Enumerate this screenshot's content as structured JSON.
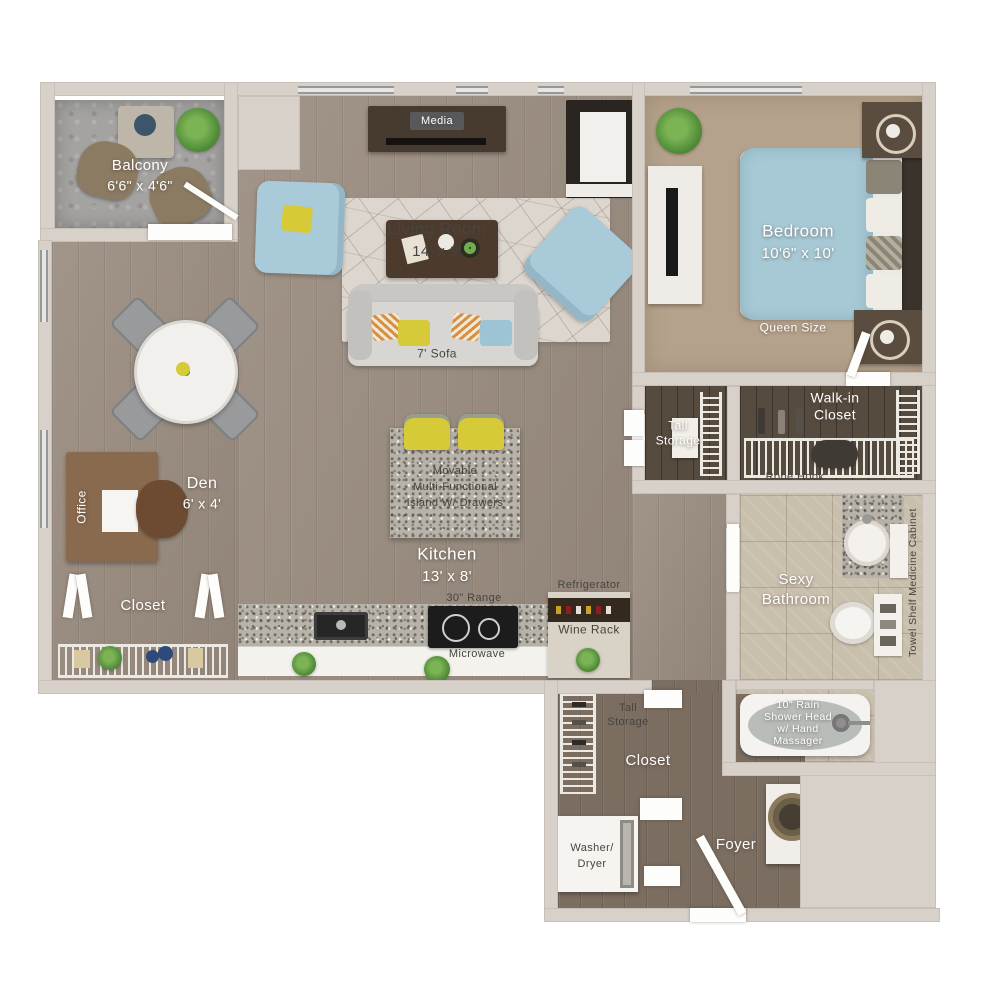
{
  "rooms": {
    "balcony": {
      "name": "Balcony",
      "dims": "6'6\" x 4'6\""
    },
    "living_room": {
      "name": "Living Room",
      "dims": "14' x 9'"
    },
    "bedroom": {
      "name": "Bedroom",
      "dims": "10'6\" x 10'"
    },
    "den": {
      "name": "Den",
      "dims": "6' x 4'"
    },
    "kitchen": {
      "name": "Kitchen",
      "dims": "13' x 8'"
    },
    "bathroom": {
      "line1": "Sexy",
      "line2": "Bathroom"
    },
    "walk_in_closet": {
      "line1": "Walk-in",
      "line2": "Closet"
    },
    "tall_storage_upper": {
      "line1": "Tall",
      "line2": "Storage"
    },
    "tall_storage_lower": {
      "line1": "Tall",
      "line2": "Storage"
    },
    "closet_left": {
      "name": "Closet"
    },
    "closet_bottom": {
      "name": "Closet"
    },
    "office": {
      "name": "Office"
    },
    "foyer": {
      "name": "Foyer"
    }
  },
  "features": {
    "media": "Media",
    "sofa": "7' Sofa",
    "queen": "Queen Size",
    "robe_hook": "Robe Hook",
    "medicine_cabinet": "Medicine Cabinet",
    "towel_shelf": "Towel Shelf",
    "island_line1": "Movable",
    "island_line2": "Multi-Functional",
    "island_line3": "Island W/ Drawers",
    "range": "30\" Range",
    "microwave": "Microwave",
    "refrigerator": "Refrigerator",
    "wine_rack": "Wine Rack",
    "washer_line1": "Washer/",
    "washer_line2": "Dryer",
    "tub_line1": "10\" Rain",
    "tub_line2": "Shower Head",
    "tub_line3": "w/ Hand",
    "tub_line4": "Massager"
  },
  "colors": {
    "wall": "#d8d1c9",
    "wood_floor": "#9a8c7f",
    "dark_wood_floor": "#7b6d60",
    "closet_floor": "#564b3f",
    "carpet": "#b5a28c",
    "tile": "#c9bfad",
    "balcony_concrete": "#a4a3a1",
    "accent_blue": "#a9cad8",
    "accent_yellow": "#d6ca38",
    "label_white": "#ffffff",
    "label_dark": "#474440"
  }
}
